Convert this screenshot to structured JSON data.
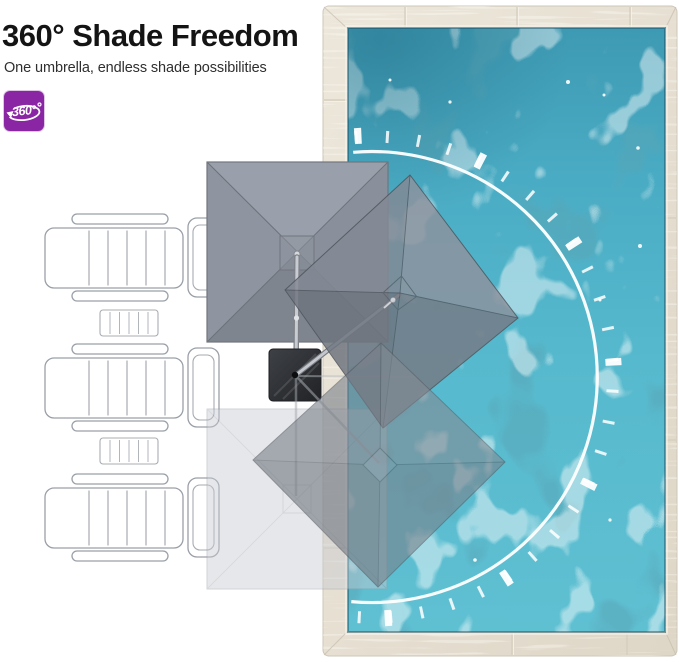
{
  "header": {
    "title": "360° Shade Freedom",
    "subtitle": "One umbrella, endless shade possibilities"
  },
  "badge": {
    "label": "360°",
    "bg_color": "#8a26a3",
    "icon": "rotation-arrow-icon"
  },
  "scene": {
    "pool": {
      "water_color": "#54b4ca",
      "deck_color": "#e6dfd2"
    },
    "umbrella": {
      "canopy_color": "#8a909b",
      "base_color": "#2b2d30",
      "positions_shown": 4
    },
    "loungers_count": 3,
    "side_tables_count": 2,
    "rotation_arc_color": "#ffffff"
  }
}
